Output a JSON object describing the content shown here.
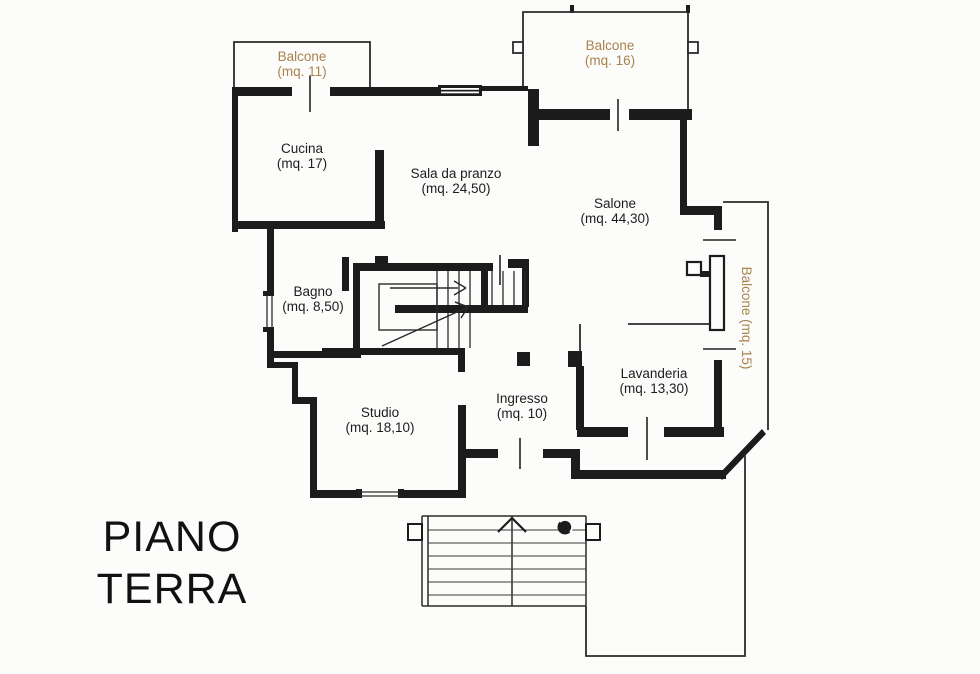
{
  "document": {
    "type": "floor-plan",
    "title_line1": "PIANO",
    "title_line2": "TERRA"
  },
  "colors": {
    "background": "#fcfcfb",
    "wall": "#1c1c1c",
    "room_label": "#1d1d1d",
    "balcony_label": "#a9824d",
    "title": "#111111"
  },
  "rooms": {
    "balcone_11": {
      "name": "Balcone",
      "area": "(mq. 11)"
    },
    "balcone_16": {
      "name": "Balcone",
      "area": "(mq. 16)"
    },
    "balcone_15": {
      "label": "Balcone (mq. 15)"
    },
    "cucina": {
      "name": "Cucina",
      "area": "(mq. 17)"
    },
    "sala_da_pranzo": {
      "name": "Sala da pranzo",
      "area": "(mq. 24,50)"
    },
    "salone": {
      "name": "Salone",
      "area": "(mq. 44,30)"
    },
    "bagno": {
      "name": "Bagno",
      "area": "(mq. 8,50)"
    },
    "lavanderia": {
      "name": "Lavanderia",
      "area": "(mq. 13,30)"
    },
    "ingresso": {
      "name": "Ingresso",
      "area": "(mq. 10)"
    },
    "studio": {
      "name": "Studio",
      "area": "(mq. 18,10)"
    }
  },
  "symbols": {
    "stair_direction_arrow": "up",
    "entry_stair_arrow": "up",
    "drain_circle": "drain"
  }
}
